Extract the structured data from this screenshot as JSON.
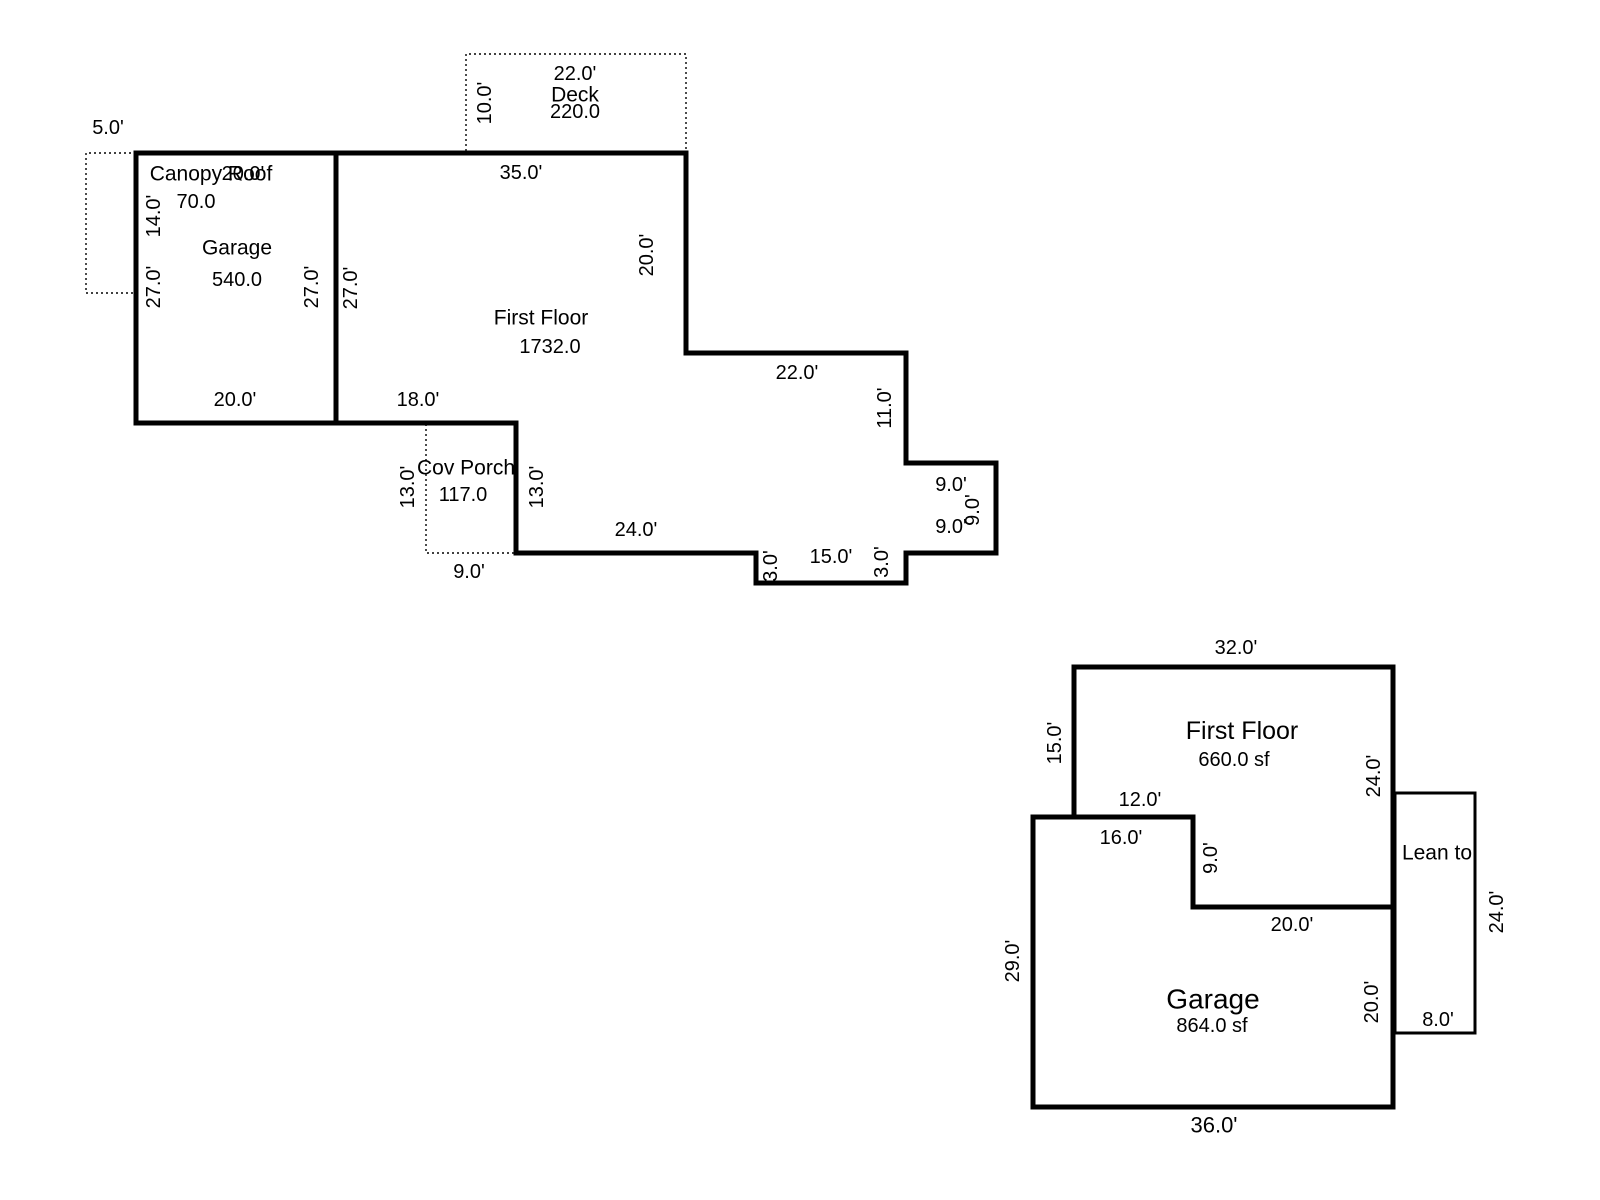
{
  "sketch1": {
    "garage": {
      "name": "Garage",
      "area": "540.0"
    },
    "first_floor": {
      "name": "First Floor",
      "area": "1732.0"
    },
    "deck": {
      "name": "Deck",
      "area": "220.0"
    },
    "canopy": {
      "name": "Canopy Roof",
      "area": "70.0"
    },
    "cov_porch": {
      "name": "Cov Porch",
      "area": "117.0"
    },
    "dims": {
      "canopy_width": "5.0'",
      "canopy_depth": "14.0'",
      "garage_top": "20.0'",
      "garage_left": "27.0'",
      "garage_right_inner": "27.0'",
      "garage_right_outer": "27.0'",
      "garage_bottom": "20.0'",
      "deck_width": "22.0'",
      "deck_depth": "10.0'",
      "ff_top": "35.0'",
      "ff_right": "20.0'",
      "step_width": "22.0'",
      "step_depth": "11.0'",
      "bump_top": "9.0'",
      "bump_right": "9.0'",
      "bump_bottom": "9.0'",
      "notch_left_side": "3.0'",
      "notch_bottom": "15.0'",
      "notch_right_side": "3.0'",
      "bottom_left_run": "24.0'",
      "porch_bottom": "9.0'",
      "porch_left": "13.0'",
      "porch_right": "13.0'",
      "ff_bottom_left": "18.0'"
    }
  },
  "sketch2": {
    "first_floor": {
      "name": "First Floor",
      "area": "660.0 sf"
    },
    "garage": {
      "name": "Garage",
      "area": "864.0 sf"
    },
    "lean_to": {
      "name": "Lean to"
    },
    "dims": {
      "ff_top": "32.0'",
      "ff_left": "15.0'",
      "ff_right": "24.0'",
      "ff_notch_width": "12.0'",
      "garage_top": "16.0'",
      "ff_step": "9.0'",
      "ff_bottom": "20.0'",
      "garage_left": "29.0'",
      "garage_right": "20.0'",
      "garage_bottom": "36.0'",
      "leanto_right": "24.0'",
      "leanto_bottom": "8.0'"
    }
  }
}
